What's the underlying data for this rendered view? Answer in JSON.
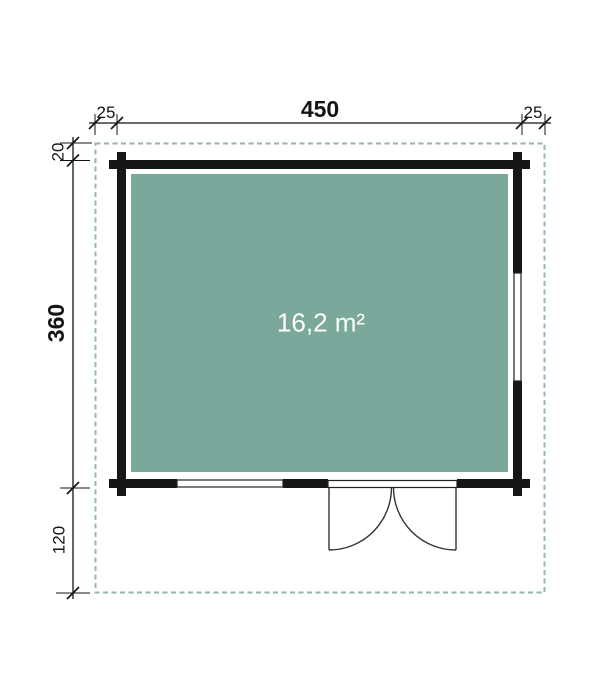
{
  "floor_plan": {
    "area_label": "16,2 m²",
    "dimensions_top": {
      "overhang_left": "25",
      "width": "450",
      "overhang_right": "25"
    },
    "dimensions_left": {
      "overhang_top": "20",
      "depth": "360",
      "front_overhang": "120"
    },
    "colors": {
      "floor": "#7aa99b",
      "roof_outline": "#93b7ab",
      "wall": "#161616",
      "dimension": "#141414",
      "area_text": "#ffffff",
      "door_window_line": "#333333"
    }
  }
}
